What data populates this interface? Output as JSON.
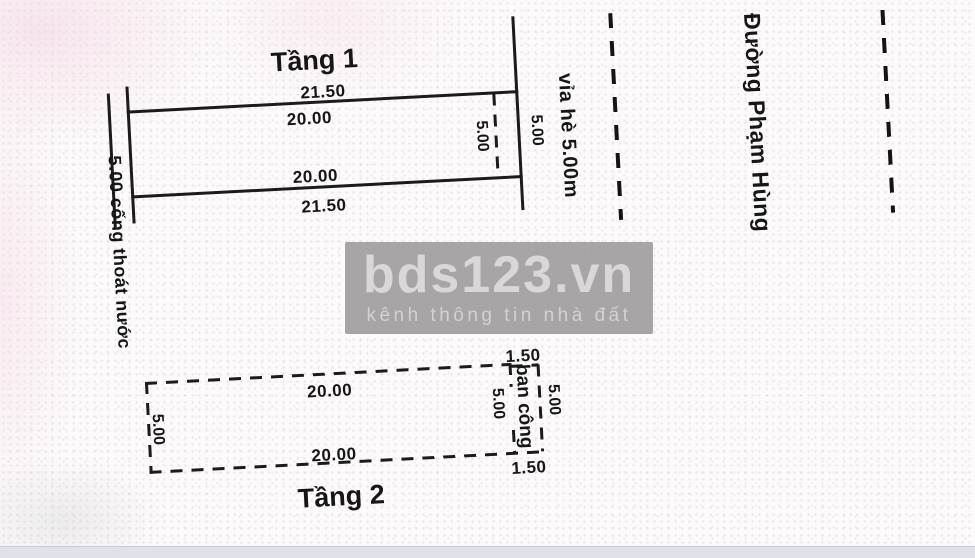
{
  "plan": {
    "floor1": {
      "title": "Tầng 1",
      "dim_top_outer": "21.50",
      "dim_top_inner": "20.00",
      "dim_bottom_inner": "20.00",
      "dim_bottom_outer": "21.50",
      "dim_depth_inner": "5.00",
      "dim_depth_frontage": "5.00"
    },
    "floor2": {
      "title": "Tầng 2",
      "dim_top": "20.00",
      "dim_bottom": "20.00",
      "dim_left": "5.00",
      "balcony_label": "ban công",
      "dim_balcony_top": "1.50",
      "dim_balcony_bottom": "1.50",
      "dim_balcony_inner": "5.00",
      "dim_balcony_outer": "5.00"
    },
    "drainage_label": "5.00 cống thoát nước",
    "sidewalk_label": "vỉa hè 5.00m",
    "street_label": "Đường Phạm Hùng"
  },
  "watermark": {
    "title": "bds123.vn",
    "subtitle": "kênh thông tin nhà đất"
  },
  "colors": {
    "line": "#1b1b1b",
    "watermark_bg": "#9d999b",
    "watermark_text": "#dad7d8",
    "bottom_strip": "#dfe2e8",
    "background": "#fcfafa"
  }
}
